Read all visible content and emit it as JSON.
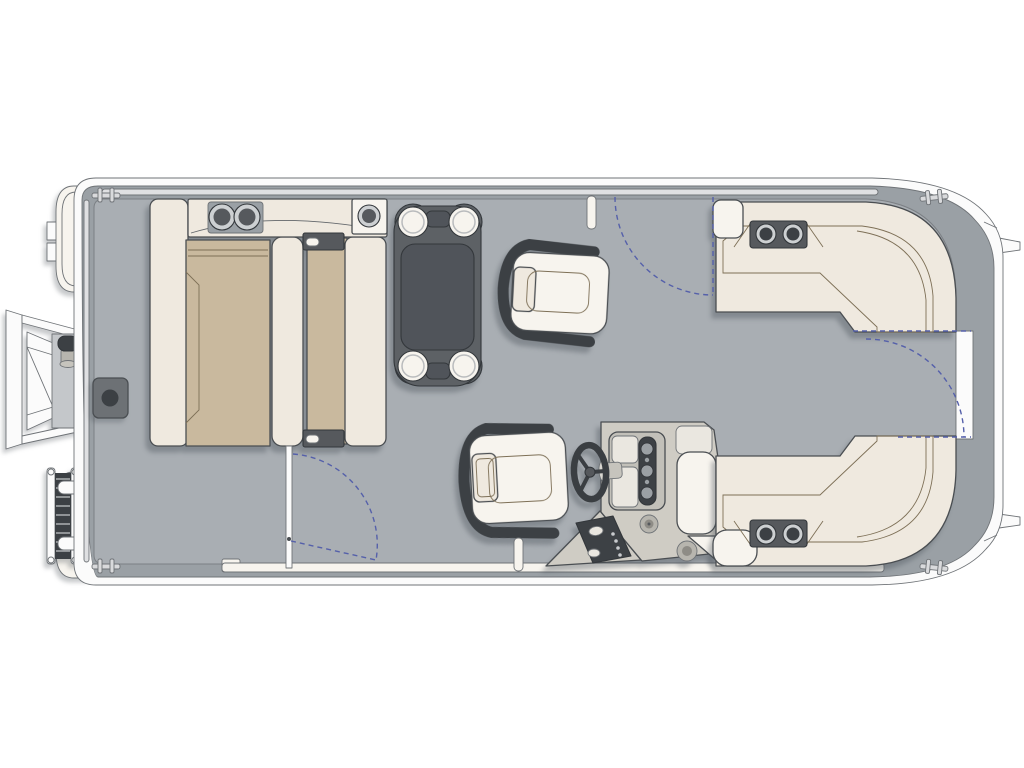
{
  "diagram": {
    "type": "pontoon-boat-floor-plan",
    "view": "top-down",
    "orientation": "bow-right-stern-left",
    "components": {
      "hull": "pontoon deck with wraparound fence",
      "bow": "curved bow fence with center walk-through gate",
      "bow_lounges": [
        "port L-shaped wraparound lounge with armrest cupholders",
        "starboard L-shaped wraparound lounge with armrest cupholders"
      ],
      "helm": "starboard helm console with steering wheel, gauges and switch panel",
      "seats": [
        "captain swivel chair",
        "companion swivel chair"
      ],
      "table": "removable pedestal table with four cup holders",
      "stern_group": "two facing bench seats with center filler and rear trunk top with three cup holders",
      "gates": [
        "port side gate with swing arc",
        "starboard side gate with swing arc",
        "bow gate with swing arc"
      ],
      "exterior": [
        "stern boarding stairs with grab knob",
        "telescoping boarding ladder",
        "pontoon tube stern caps",
        "pontoon tube bow noses with fins",
        "four mooring cleats"
      ]
    },
    "gate_count": 3,
    "cupholder_count": 11,
    "cleat_count": 4
  },
  "colors": {
    "trim_white": "#fbfbfb",
    "band_gray": "#9aa0a5",
    "floor_gray": "#a9aeb3",
    "rail_light": "#dfe0e2",
    "cream": "#efe9df",
    "cream_bright": "#f7f4ee",
    "tan": "#c9b99e",
    "dark_gray": "#56595d",
    "charcoal": "#3c4044",
    "table_gray": "#5d6165",
    "table_inner": "#50545a",
    "console_gray": "#cfccc4",
    "console_panel": "#eae7e0",
    "gauge_dark": "#3d4145",
    "metal_gray": "#b7b5ae",
    "ring_gray": "#cdd0d2",
    "blue_dash": "#5560aa",
    "panel_gray": "#c4c7ca",
    "square_gray": "#6d7175"
  }
}
